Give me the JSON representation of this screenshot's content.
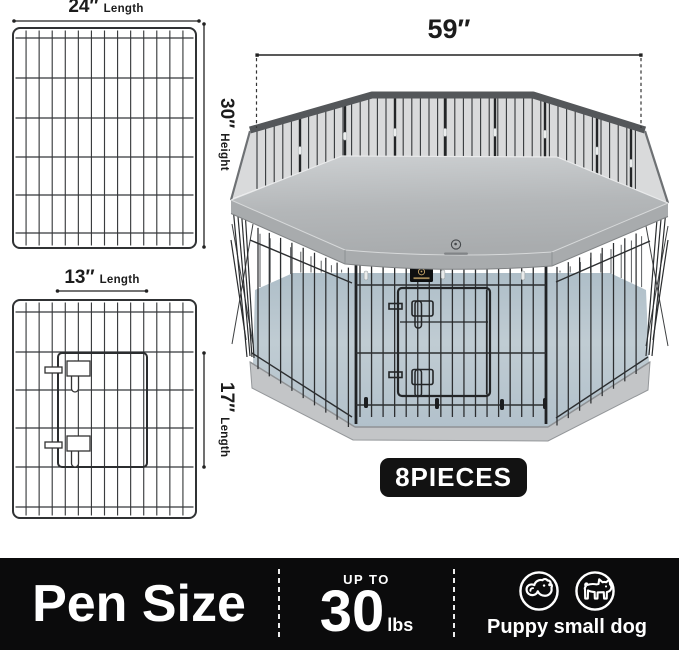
{
  "panels": {
    "full_panel": {
      "width_value": "24″",
      "width_unit": "Length",
      "height_value": "30″",
      "height_unit": "Height"
    },
    "door_panel": {
      "width_value": "13″",
      "width_unit": "Length",
      "height_value": "17″",
      "height_unit": "Length"
    }
  },
  "pen": {
    "top_width_value": "59″",
    "pieces_label": "8PIECES"
  },
  "bottom_bar": {
    "title": "Pen Size",
    "weight": {
      "prefix": "UP TO",
      "value": "30",
      "unit": "lbs"
    },
    "pets": {
      "label": "Puppy small dog",
      "icons": [
        "puppy-icon",
        "small-dog-icon"
      ]
    }
  },
  "colors": {
    "bar_bg": "#0b0b0c",
    "badge_bg": "#121212",
    "text_on_dark": "#ffffff",
    "dim_text": "#1c1c1c",
    "cover_gray": "#b5b8ba",
    "mesh_gray": "#d9dadb",
    "floor_blue_gray": "#b9c6ce",
    "base_gray": "#c3c5c7",
    "wire_dark": "#35373a"
  }
}
